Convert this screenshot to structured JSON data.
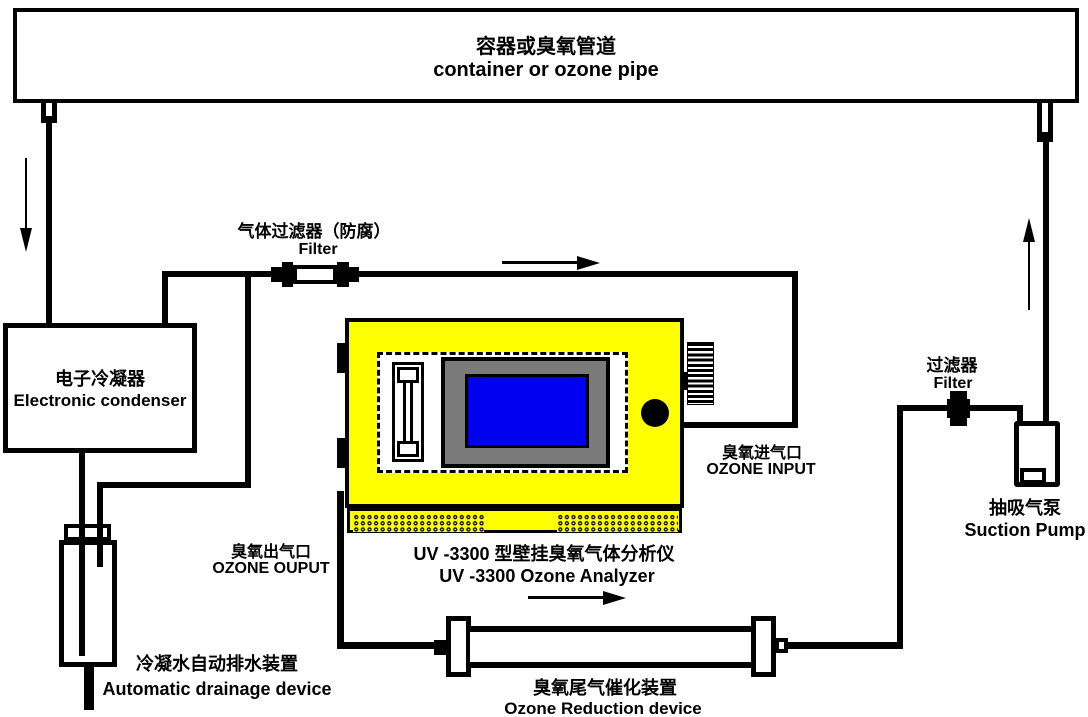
{
  "diagram_title": "UV-3300 ozone analyzer sampling system diagram",
  "colors": {
    "line": "#000000",
    "analyzer_body": "#ffff00",
    "display_bezel": "#7a7a7a",
    "display_screen": "#0000f0",
    "background": "#ffffff"
  },
  "container_pipe": {
    "label_zh": "容器或臭氧管道",
    "label_en": "container or ozone pipe"
  },
  "condenser": {
    "label_zh": "电子冷凝器",
    "label_en": "Electronic condenser"
  },
  "gas_filter": {
    "label_zh": "气体过滤器（防腐）",
    "label_en": "Filter"
  },
  "analyzer": {
    "label_zh": "UV -3300 型壁挂臭氧气体分析仪",
    "label_en": "UV -3300 Ozone Analyzer"
  },
  "ozone_input": {
    "label_zh": "臭氧进气口",
    "label_en": "OZONE INPUT"
  },
  "ozone_output": {
    "label_zh": "臭氧出气口",
    "label_en": "OZONE OUPUT"
  },
  "drainage": {
    "label_zh": "冷凝水自动排水装置",
    "label_en": "Automatic drainage device"
  },
  "reduction": {
    "label_zh": "臭氧尾气催化装置",
    "label_en": "Ozone Reduction device"
  },
  "right_filter": {
    "label_zh": "过滤器",
    "label_en": "Filter"
  },
  "pump": {
    "label_zh": "抽吸气泵",
    "label_en": "Suction Pump"
  }
}
